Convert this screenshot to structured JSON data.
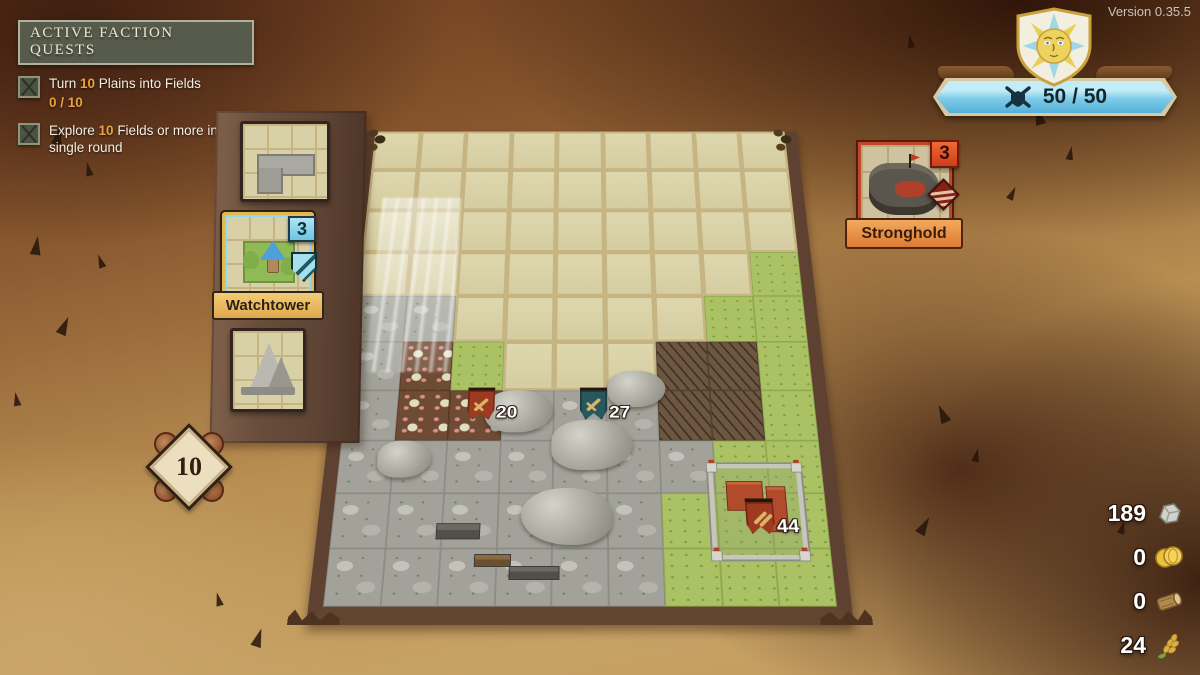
{
  "version_label": "Version 0.35.5",
  "quest_panel": {
    "title": "ACTIVE FACTION QUESTS",
    "quests": [
      {
        "text_pre": "Turn ",
        "text_num": "10",
        "text_post": " Plains into Fields",
        "progress": "0 / 10"
      },
      {
        "text_pre": "Explore ",
        "text_num": "10",
        "text_post": " Fields or more in a single round"
      }
    ]
  },
  "army_capacity": {
    "value": "50 / 50"
  },
  "round_counter": {
    "value": "10"
  },
  "left_dock": {
    "watchtower_card": {
      "label": "Watchtower",
      "count": "3"
    }
  },
  "stronghold_card": {
    "label": "Stronghold",
    "count": "3"
  },
  "resources": [
    {
      "name": "stone",
      "value": "189"
    },
    {
      "name": "coins",
      "value": "0"
    },
    {
      "name": "wood",
      "value": "0"
    },
    {
      "name": "wheat",
      "value": "24"
    }
  ],
  "board": {
    "tile_legend": {
      "E": "unexplored-plain",
      "G": "grass",
      "R": "rock",
      "D": "mushroom-dirt",
      "B": "badlands",
      "V": "village-rock",
      "C": "castle-grass"
    },
    "tile_rows": [
      "EEEEEEEEE",
      "EEEEEEEEE",
      "EEEEEEEEE",
      "EEEEEEEEG",
      "RREEEEEGG",
      "RDGEEEBBG",
      "RDDRRRBBG",
      "RRRRRRRGG",
      "RRRRRRGCG",
      "RVVRRRGCG"
    ],
    "markers": [
      {
        "name": "red-army-flag",
        "value": "20",
        "color": "#9e3a20",
        "icon": "sword",
        "x": 26,
        "y": 59.5
      },
      {
        "name": "teal-army-flag",
        "value": "27",
        "color": "#27585e",
        "icon": "sword",
        "x": 50,
        "y": 59.5
      },
      {
        "name": "stronghold-army-flag",
        "value": "44",
        "color": "#9e3a20",
        "icon": "arrows",
        "x": 83.5,
        "y": 81
      }
    ]
  },
  "icons": {
    "quest-checkbox": "square with cracked X",
    "sword": "gold diagonal sword",
    "arrows": "two gold arrows",
    "capacity": "crossed swords with shield",
    "sun-crest": "sun face on shield",
    "stone": "grey rock",
    "coins": "gold coins",
    "wood": "log",
    "wheat": "wheat stalk"
  },
  "colors": {
    "quest_accent": "#e8a33d",
    "capacity_banner_blue": "#7fcbe8",
    "watchtower_accent": "#8fd8ef",
    "stronghold_accent": "#c2472a"
  }
}
